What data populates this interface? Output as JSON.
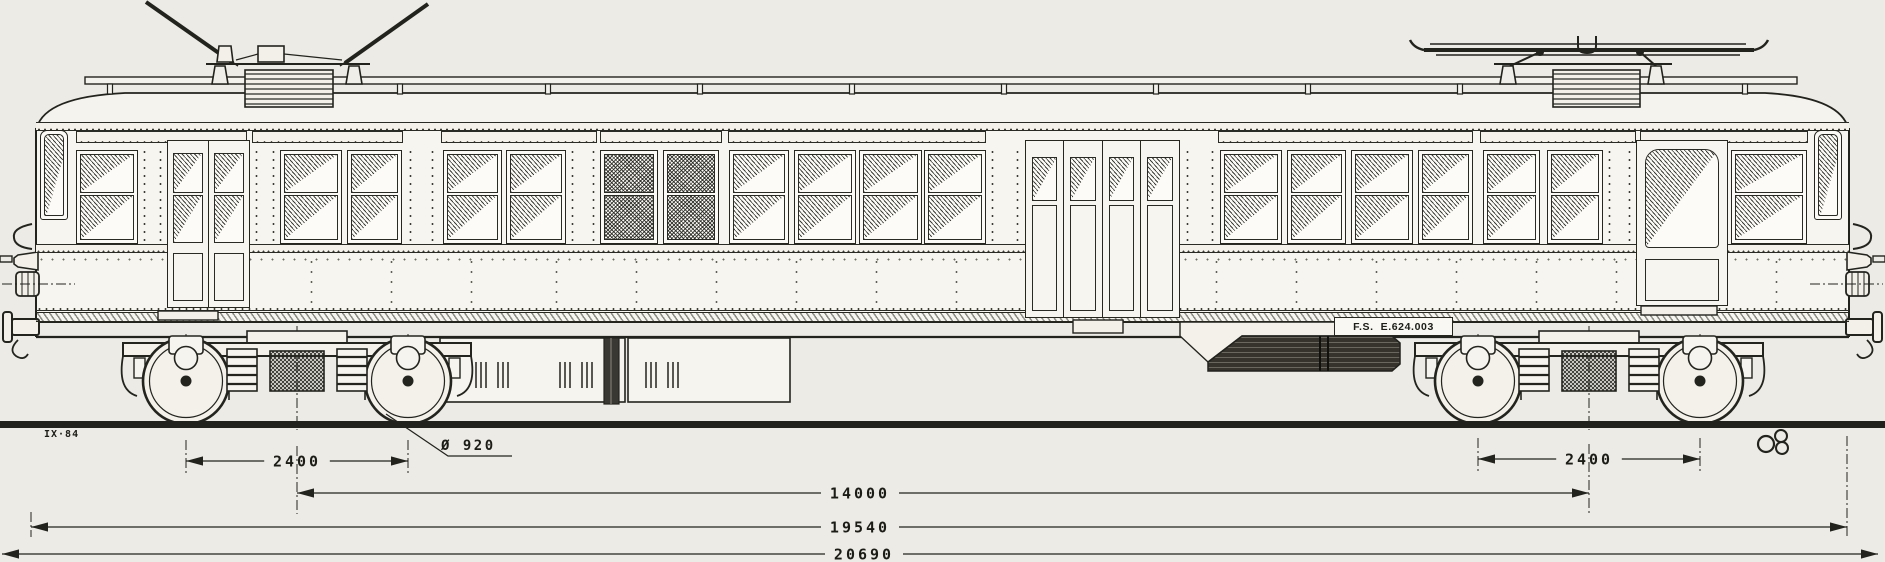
{
  "page": {
    "paper": "#edebe5",
    "ink": "#23231e",
    "body_fill": "#f6f5ef"
  },
  "labels": {
    "vehicle_number": "F.S.  E.624.003",
    "date_mark": "IX·84",
    "wheel_diameter": "Ø 920"
  },
  "dimensions": [
    {
      "id": "left-bogie-wheelbase",
      "label": "2400",
      "x1": 186,
      "x2": 408,
      "y": 461
    },
    {
      "id": "right-bogie-wheelbase",
      "label": "2400",
      "x1": 1478,
      "x2": 1700,
      "y": 459
    },
    {
      "id": "bogie-centres",
      "label": "14000",
      "x1": 297,
      "x2": 1589,
      "y": 493,
      "label_x": 860
    },
    {
      "id": "body-length",
      "label": "19540",
      "x1": 31,
      "x2": 1847,
      "y": 527,
      "label_x": 860
    },
    {
      "id": "overall-length",
      "label": "20690",
      "x1": 2,
      "x2": 1878,
      "y": 554,
      "label_x": 864
    }
  ],
  "extensions": [
    {
      "x": 186,
      "y1": 440,
      "y2": 476
    },
    {
      "x": 408,
      "y1": 440,
      "y2": 476
    },
    {
      "x": 297,
      "y1": 446,
      "y2": 514
    },
    {
      "x": 1478,
      "y1": 438,
      "y2": 474
    },
    {
      "x": 1700,
      "y1": 438,
      "y2": 474
    },
    {
      "x": 1589,
      "y1": 444,
      "y2": 514
    },
    {
      "x": 31,
      "y1": 512,
      "y2": 537
    },
    {
      "x": 1847,
      "y1": 436,
      "y2": 537
    }
  ],
  "structure": {
    "windows": [
      {
        "kind": "cab",
        "x": 40,
        "w": 28
      },
      {
        "kind": "end2",
        "x": 76,
        "w": 62
      },
      {
        "kind": "pass",
        "x": 280,
        "w": 62
      },
      {
        "kind": "pass",
        "x": 347,
        "w": 55
      },
      {
        "kind": "pass",
        "x": 443,
        "w": 59
      },
      {
        "kind": "pass",
        "x": 506,
        "w": 60
      },
      {
        "kind": "dark",
        "x": 600,
        "w": 58
      },
      {
        "kind": "dark",
        "x": 663,
        "w": 56
      },
      {
        "kind": "pass",
        "x": 729,
        "w": 60
      },
      {
        "kind": "pass",
        "x": 794,
        "w": 62
      },
      {
        "kind": "pass",
        "x": 859,
        "w": 63
      },
      {
        "kind": "pass",
        "x": 924,
        "w": 62
      },
      {
        "kind": "pass",
        "x": 1220,
        "w": 62
      },
      {
        "kind": "pass",
        "x": 1287,
        "w": 59
      },
      {
        "kind": "pass",
        "x": 1351,
        "w": 62
      },
      {
        "kind": "pass",
        "x": 1418,
        "w": 55
      },
      {
        "kind": "pass",
        "x": 1483,
        "w": 57
      },
      {
        "kind": "pass",
        "x": 1547,
        "w": 56
      },
      {
        "kind": "end2",
        "x": 1731,
        "w": 76
      },
      {
        "kind": "cab",
        "x": 1814,
        "w": 28
      }
    ],
    "pillars": [
      {
        "x": 140,
        "w": 25
      },
      {
        "x": 252,
        "w": 26
      },
      {
        "x": 406,
        "w": 31
      },
      {
        "x": 568,
        "w": 30
      },
      {
        "x": 988,
        "w": 34
      },
      {
        "x": 1183,
        "w": 34
      },
      {
        "x": 1605,
        "w": 29
      }
    ],
    "letterboards": [
      [
        76,
        247
      ],
      [
        252,
        403
      ],
      [
        441,
        597
      ],
      [
        600,
        722
      ],
      [
        728,
        986
      ],
      [
        1218,
        1473
      ],
      [
        1480,
        1636
      ],
      [
        1640,
        1808
      ]
    ],
    "rivet_columns": [
      230,
      310,
      390,
      470,
      555,
      635,
      715,
      795,
      875,
      955,
      1215,
      1295,
      1375,
      1455,
      1535,
      1615,
      1695,
      1775
    ],
    "roof_posts": [
      110,
      250,
      400,
      548,
      700,
      852,
      1004,
      1156,
      1308,
      1460,
      1612,
      1745
    ],
    "doors": {
      "left": {
        "x": 167,
        "w": 83,
        "leaves": 2
      },
      "center": {
        "x": 1025,
        "w": 155,
        "leaves": 4
      },
      "right": {
        "x": 1636,
        "w": 92,
        "leaves": 1
      }
    }
  },
  "icons": {
    "artist_monogram": "clover-monogram"
  }
}
